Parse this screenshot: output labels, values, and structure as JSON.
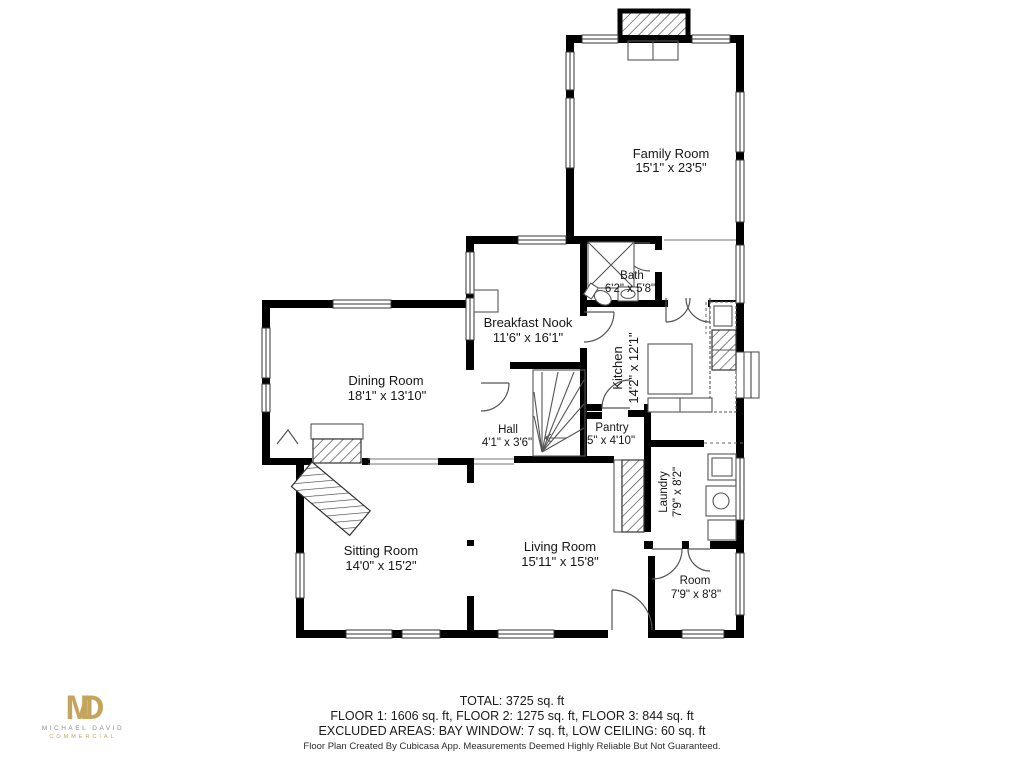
{
  "page": {
    "background": "#ffffff"
  },
  "logo": {
    "monogram": "MD",
    "name": "MICHAEL DAVID",
    "division": "COMMERCIAL",
    "gold": "#c5a55e",
    "gray": "#8e8e8e"
  },
  "rooms": {
    "family_room": {
      "name": "Family Room",
      "dims": "15'1\" x 23'5\""
    },
    "bath": {
      "name": "Bath",
      "dims": "6'2\" x 5'8\""
    },
    "breakfast_nook": {
      "name": "Breakfast Nook",
      "dims": "11'6\" x 16'1\""
    },
    "dining_room": {
      "name": "Dining Room",
      "dims": "18'1\" x 13'10\""
    },
    "kitchen": {
      "name": "Kitchen",
      "dims": "14'2\" x 12'1\""
    },
    "hall": {
      "name": "Hall",
      "dims": "4'1\" x 3'6\""
    },
    "pantry": {
      "name": "Pantry",
      "dims": "5\" x 4'10\""
    },
    "laundry": {
      "name": "Laundry",
      "dims": "7'9\" x 8'2\""
    },
    "sitting_room": {
      "name": "Sitting Room",
      "dims": "14'0\" x 15'2\""
    },
    "living_room": {
      "name": "Living Room",
      "dims": "15'11\" x 15'8\""
    },
    "room": {
      "name": "Room",
      "dims": "7'9\" x 8'8\""
    }
  },
  "summary": {
    "total": "TOTAL: 3725 sq. ft",
    "floors": "FLOOR 1: 1606 sq. ft, FLOOR 2: 1275 sq. ft, FLOOR 3: 844 sq. ft",
    "excluded": "EXCLUDED AREAS: BAY WINDOW: 7 sq. ft, LOW CEILING: 60 sq. ft"
  },
  "footer": {
    "credit": "Floor Plan Created By Cubicasa App. Measurements Deemed Highly Reliable But Not Guaranteed."
  }
}
